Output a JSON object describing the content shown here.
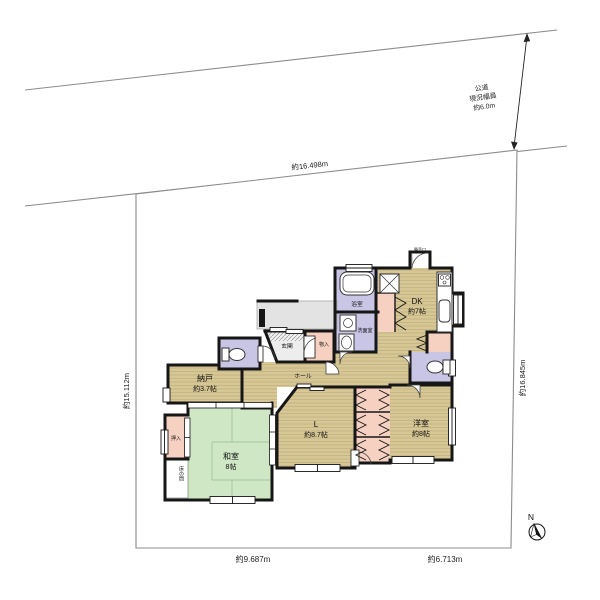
{
  "site": {
    "road": {
      "line1": "公道",
      "line2": "現況幅員",
      "line3": "約6.0m"
    },
    "dimensions": {
      "top": "約16.498m",
      "left": "約15.112m",
      "right": "約16.845m",
      "bottom_left": "約9.687m",
      "bottom_right": "約6.713m"
    },
    "north_label": "N"
  },
  "rooms": {
    "dk": {
      "name": "DK",
      "size": "約7帖"
    },
    "nando": {
      "name": "納戸",
      "size": "約3.7帖"
    },
    "living": {
      "name": "L",
      "size": "約8.7帖"
    },
    "western_room": {
      "name": "洋室",
      "size": "約8帖"
    },
    "japanese_room": {
      "name": "和室",
      "size": "8帖"
    },
    "bathroom": "浴室",
    "washroom": "洗面室",
    "entrance": "玄関",
    "storage_small": "物入",
    "hall": "ホール",
    "closet": "押入",
    "tokonoma": "床の間",
    "back_door": "勝手口"
  },
  "colors": {
    "wood_floor": "#d6c795",
    "wood_stripe": "#bfae7e",
    "tatami": "#cfe7c5",
    "tatami_line": "#a3c49c",
    "water_rooms": "#c9c5e5",
    "closets": "#f6d1c1",
    "porch": "#e3e3e3",
    "walls": "#161616"
  }
}
